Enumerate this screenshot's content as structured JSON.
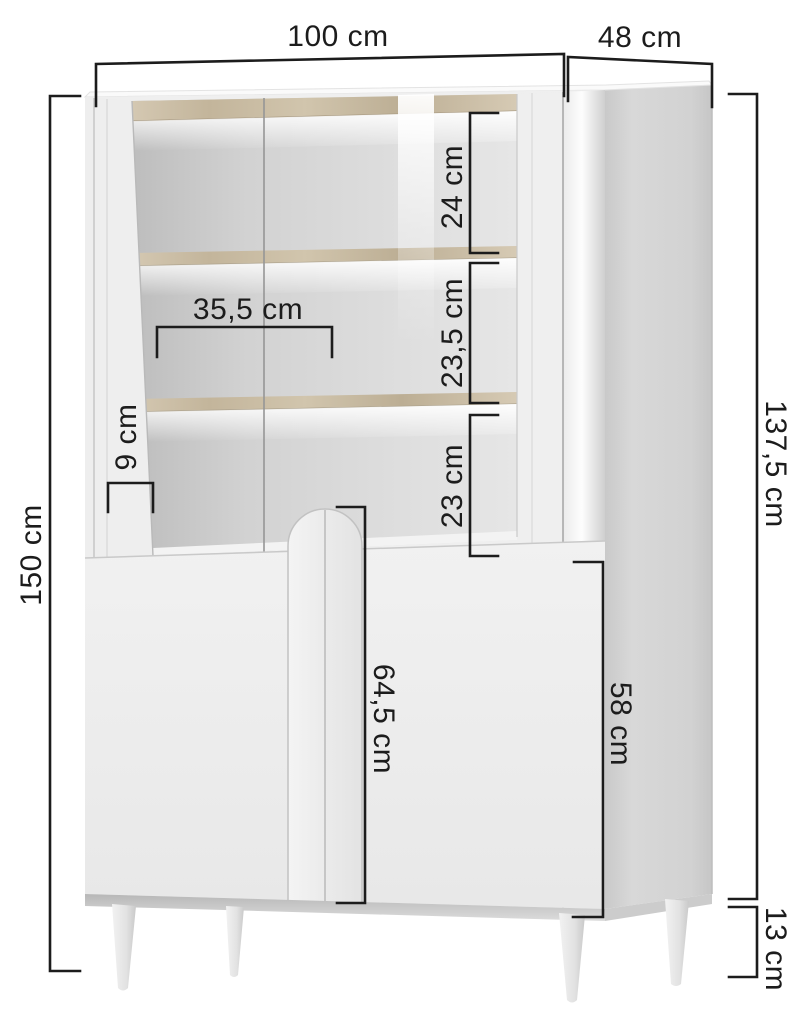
{
  "diagram": {
    "title": "Display cabinet dimension diagram",
    "unit": "cm",
    "dimensions": {
      "total_width": "100 cm",
      "depth": "48 cm",
      "total_height": "150 cm",
      "body_height": "137,5 cm",
      "upper_compartment_top": "24 cm",
      "upper_compartment_middle": "23,5 cm",
      "upper_compartment_bottom": "23 cm",
      "inner_width": "35,5 cm",
      "side_frame_width": "9 cm",
      "lower_door_height": "64,5 cm",
      "lower_side_height": "58 cm",
      "leg_height": "13 cm"
    },
    "colors": {
      "background": "#ffffff",
      "dimension_line": "#1c1c1c",
      "cabinet_body": "#efefef",
      "cabinet_side": "#d2d2d2",
      "wood_shelf": "#ccbfa7"
    }
  }
}
